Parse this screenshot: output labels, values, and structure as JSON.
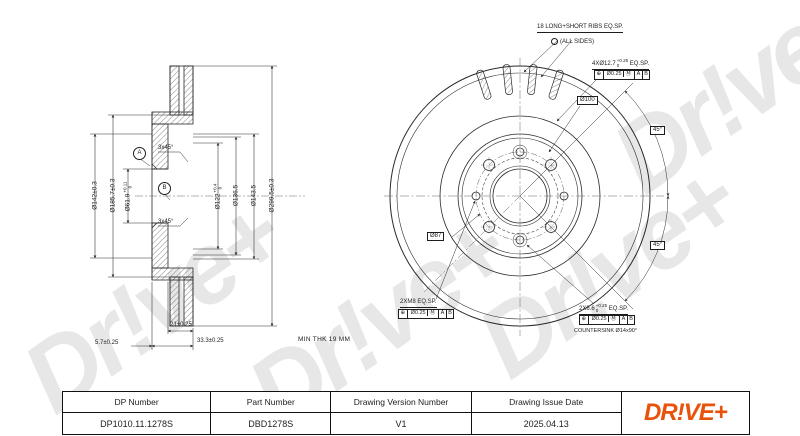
{
  "watermark_text": "Dr!ve+",
  "colors": {
    "logo_orange": "#e8520a",
    "watermark_gray": "#e7e7e7",
    "line": "#2a2a2a"
  },
  "side_view": {
    "diameters": [
      {
        "text": "Ø142±0.3",
        "sup": "",
        "sub": ""
      },
      {
        "text": "Ø185.7±0.3",
        "sup": "",
        "sub": ""
      },
      {
        "text": "Ø61.9",
        "sup": "+0.11",
        "sub": "0"
      },
      {
        "text": "Ø122",
        "sup": "+0.4",
        "sub": "0"
      },
      {
        "text": "Ø136.5",
        "sup": "",
        "sub": ""
      },
      {
        "text": "Ø143.5",
        "sup": "",
        "sub": ""
      },
      {
        "text": "Ø299.5±0.3",
        "sup": "",
        "sub": ""
      }
    ],
    "chamfer_top": "3x45°",
    "chamfer_bottom": "3x45°",
    "datum_a": "A",
    "datum_b": "B",
    "dim_hat_depth": "21±0.25",
    "dim_flange_thk": "5.7±0.25",
    "dim_total_width": "33.3±0.25",
    "min_thk": "MIN THK 19 MM"
  },
  "front_view": {
    "ribs_line1": "18 LONG+SHORT RIBS EQ.SP.",
    "ribs_line2": "(ALL SIDES)",
    "holes_label": "4XØ12.7",
    "holes_sup": "+0.25",
    "holes_sub": "0",
    "holes_suffix": "EQ.SP.",
    "fcf_top": {
      "sym": "⊕",
      "tol": "Ø0.25",
      "mod": "Ⓜ",
      "d1": "A",
      "d2": "B"
    },
    "bolt_circle_label": "Ø100",
    "hub_label": "Ø87",
    "angle_top": "45°",
    "angle_bottom": "45°",
    "m8_label": "2XM8 EQ.SP.",
    "fcf_left": {
      "sym": "⊕",
      "tol": "Ø0.25",
      "mod": "Ⓜ",
      "d1": "A",
      "d2": "B"
    },
    "cs_label": "2X6.6",
    "cs_sup": "+0.25",
    "cs_sub": "0",
    "cs_suffix": "EQ.SP.",
    "fcf_right": {
      "sym": "⊕",
      "tol": "Ø0.25",
      "mod": "Ⓜ",
      "d1": "A",
      "d2": "B"
    },
    "countersink_label": "COUNTERSINK Ø14x90°"
  },
  "title_block": {
    "columns": [
      {
        "header": "DP Number",
        "value": "DP1010.11.1278S"
      },
      {
        "header": "Part Number",
        "value": "DBD1278S"
      },
      {
        "header": "Drawing Version Number",
        "value": "V1"
      },
      {
        "header": "Drawing Issue Date",
        "value": "2025.04.13"
      }
    ],
    "logo": "DR!VE+"
  }
}
